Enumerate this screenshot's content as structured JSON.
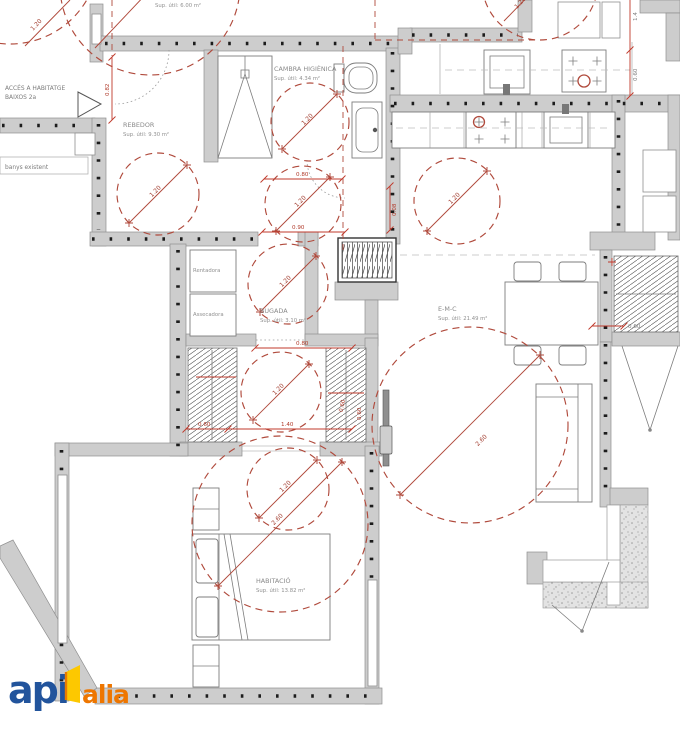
{
  "labels": {
    "sup_top": "Sup. útil: 6.00 m²",
    "acces_1": "ACCÉS A HABITATGE",
    "acces_2": "BAIXOS 2a",
    "banys": "banys existent"
  },
  "rooms": {
    "rebedor": {
      "name": "REBEDOR",
      "area": "Sup. útil: 9.30 m²"
    },
    "cambra": {
      "name": "CAMBRA HIGIÈNICA",
      "area": "Sup. útil: 4.34 m²"
    },
    "bugada": {
      "name": "BUGADA",
      "area": "Sup. útil: 3.10 m²"
    },
    "emc": {
      "name": "E-M-C",
      "area": "Sup. útil: 21.49 m²"
    },
    "habitacio": {
      "name": "HABITACIÓ",
      "area": "Sup. útil: 13.82 m²"
    }
  },
  "appliances": {
    "rentadora": "Rentadora",
    "assecadora": "Assecadora"
  },
  "dims": {
    "d082": "0.82",
    "d080": "0.80",
    "d090": "0.90",
    "d008": "0.08",
    "d060": "0.60",
    "d140": "1.40",
    "d14": "1.4",
    "r120": "1.20",
    "r260": "2.60"
  },
  "logo": {
    "api": "api",
    "alia": "alia"
  },
  "colors": {
    "wall": "#cdcdcd",
    "red_dashed": "#b04a3c",
    "dim_red": "#c0392b",
    "label_gray": "#8a8a8a",
    "logo_blue": "#22549c",
    "logo_orange": "#ee7600",
    "logo_yellow": "#fdc800"
  }
}
